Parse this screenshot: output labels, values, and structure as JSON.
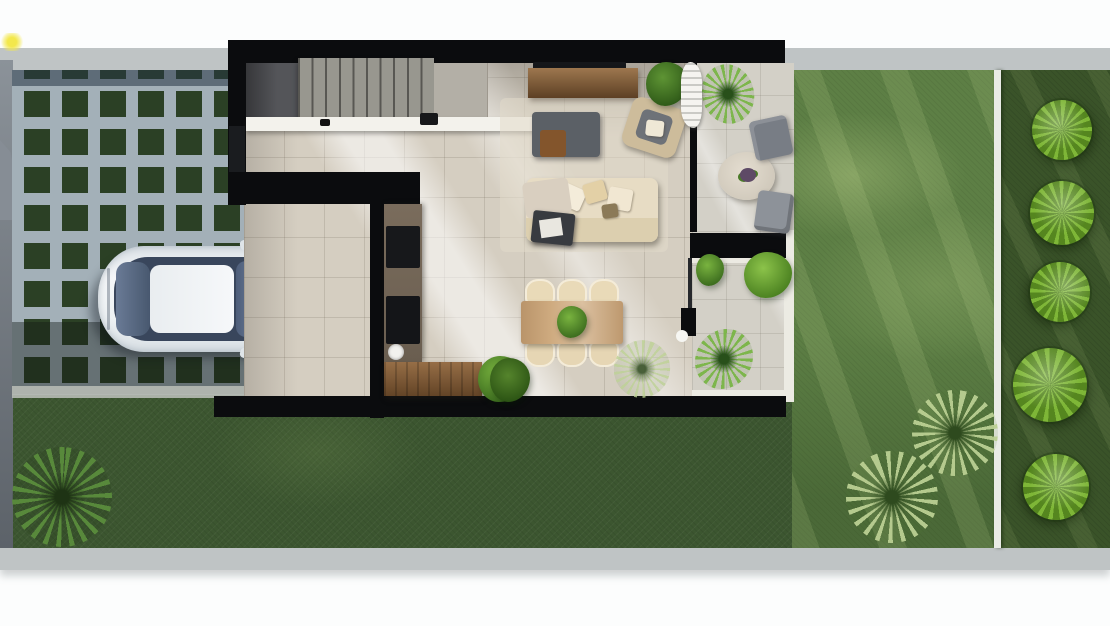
{
  "scene": {
    "title": "Top-down architectural render of a narrow-lot modern house",
    "view": "overhead site plan render",
    "rooms": [
      "carport",
      "staircase",
      "kitchen",
      "dining-area",
      "living-room",
      "side-patio",
      "backyard-lawn"
    ]
  },
  "palette": {
    "page_white": "#fcfdfd",
    "concrete": "#bfc4c5",
    "concrete_dark": "#8e979c",
    "grass_dark": "#3c5630",
    "lawn": "#5d7f45",
    "hedge": "#3a5329",
    "paver_gap": "#2b4025",
    "paver": "#a3b0b8",
    "wall_black": "#0b0c0e",
    "floor_beige": "#d5cec1",
    "patio_gray": "#d3d0c7",
    "stair_gray": "#98978f",
    "landing_gray": "#545559",
    "wood_dark": "#7c5530",
    "wood_light": "#cfab80",
    "sofa_cream": "#e7dcc4",
    "chair_cream": "#e9dab8",
    "furn_gray": "#5b6066",
    "tree_green": "#7eb637",
    "bush_green": "#4a7a28",
    "car_white": "#edf1f4",
    "car_glass": "#3c4a5e",
    "curtain_white": "#f5f4f0",
    "edge_line": "#e9ebe5",
    "sun_yellow": "#f3e84c",
    "flower_purple": "#5e4a66"
  },
  "objects": {
    "vehicle": {
      "type": "white sedan",
      "location": "grass-paver carport"
    },
    "furniture": [
      "tv-console",
      "tv",
      "ottoman",
      "ottoman-cube",
      "armchair",
      "sofa",
      "striped-throw-chair",
      "magazine-rack",
      "dining-table",
      "dining-chairs-x6",
      "table-centerpiece",
      "kitchen-counter",
      "cooktop",
      "oven",
      "kitchen-sink",
      "kitchen-island",
      "stairs",
      "white-counter",
      "faucet"
    ],
    "patio": [
      "round-table",
      "flower-vase",
      "patio-chair-upper",
      "patio-chair-lower",
      "privacy-wall",
      "curtain"
    ],
    "landscaping": [
      "paver-grid-driveway",
      "front-sidewalk",
      "rear-sidewalk",
      "edge-path-line",
      "shrub-tree-x5",
      "lawn-palm-x2",
      "front-yard-palm",
      "patio-palms",
      "potted-plants",
      "white-flower-plant"
    ]
  }
}
